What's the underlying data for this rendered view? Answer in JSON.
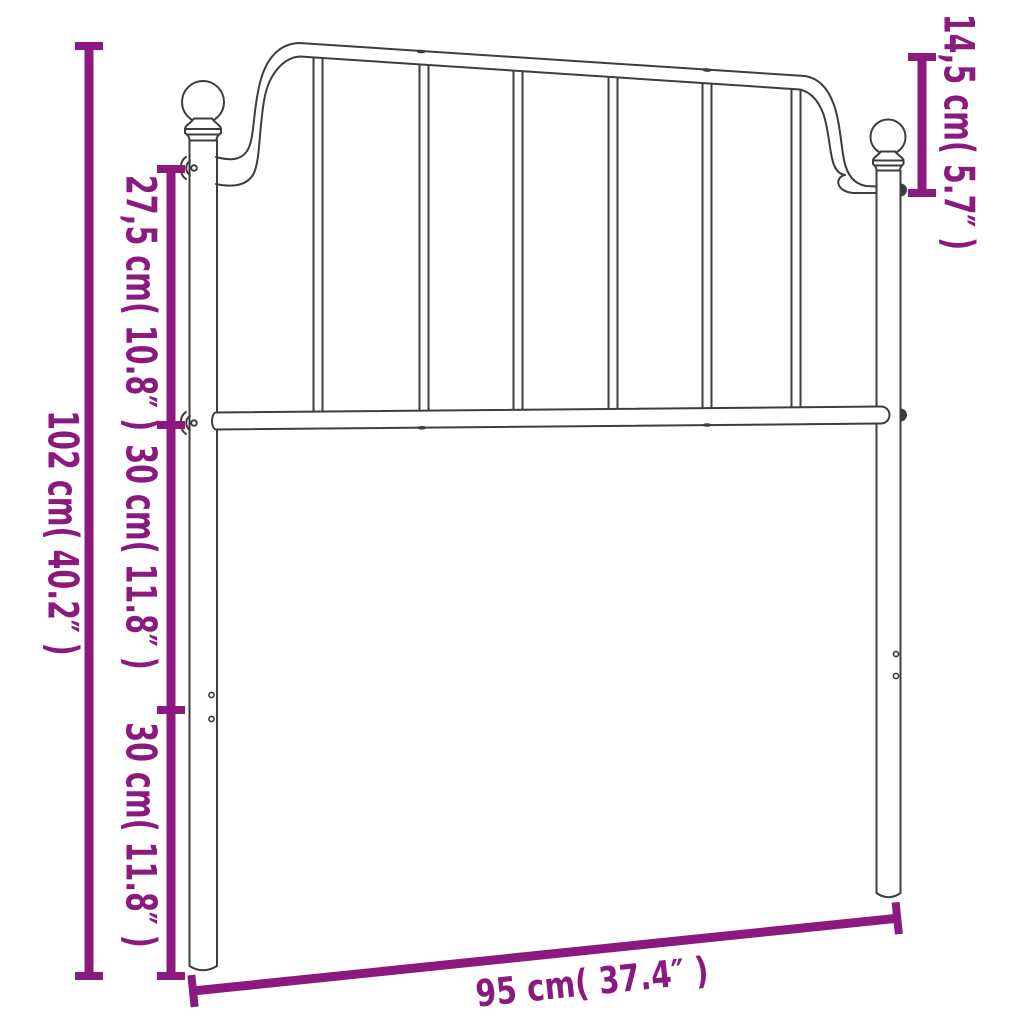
{
  "labels": {
    "total_height": "102 cm( 40.2″ )",
    "upper_section": "27,5 cm( 10.8″ )",
    "middle_section": "30 cm( 11.8″ )",
    "lower_section": "30 cm( 11.8″ )",
    "finial_height": "14,5 cm( 5.7″ )",
    "width": "95 cm( 37.4″ )"
  },
  "colors": {
    "dimension_accent": "#8B1A7E",
    "outline": "#3D3D3D",
    "background": "#FFFFFF"
  }
}
